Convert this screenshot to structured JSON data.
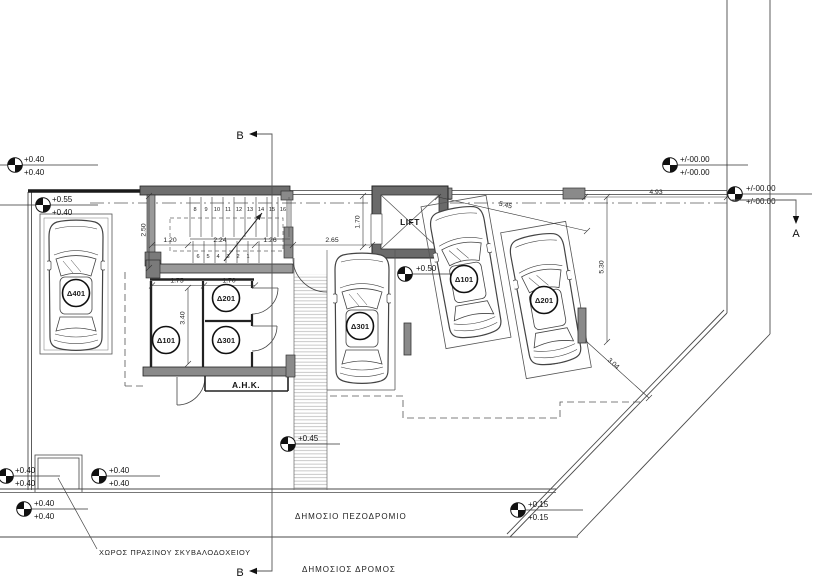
{
  "labels": {
    "lift": "LIFT",
    "ahk": "A.H.K.",
    "sidewalk": "ΔΗΜΟΣΙΟ ΠΕΖΟΔΡΟΜΙΟ",
    "road": "ΔΗΜΟΣΙΟΣ ΔΡΟΜΟΣ",
    "bin": "ΧΩΡΟΣ ΠΡΑΣΙΝΟΥ ΣΚΥΒΑΛΟΔΟΧΕΙΟΥ"
  },
  "sections": {
    "a": "A",
    "b_top": "B",
    "b_bottom": "B"
  },
  "levels": [
    {
      "a": "+0.40",
      "b": "+0.40"
    },
    {
      "a": "+0.55",
      "b": "+0.40"
    },
    {
      "a": "+0.50"
    },
    {
      "a": "+/-00.00",
      "b": "+/-00.00"
    },
    {
      "a": "+/-00.00",
      "b": "+/-00.00"
    },
    {
      "a": "+0.45"
    },
    {
      "a": "+0.15",
      "b": "+0.15"
    },
    {
      "a": "+0.40",
      "b": "+0.40"
    },
    {
      "a": "+0.40",
      "b": "+0.40"
    },
    {
      "a": "+0.40",
      "b": "+0.40"
    }
  ],
  "dims": {
    "stair_hall_depth": "2.50",
    "flight_w": "1.20",
    "stair_len": "2.24",
    "landing": "1.26",
    "entry_w": "2.65",
    "lift_depth": "1.70",
    "store1_w": "1.75",
    "store23_w": "1.70",
    "store_depth": "3.40",
    "bay_len": "5.45",
    "side_len": "5.30",
    "front_len": "4.93",
    "corner": "3.04"
  },
  "stairs": {
    "upper": [
      "8",
      "9",
      "10",
      "11",
      "12",
      "13",
      "14",
      "15",
      "16"
    ],
    "lower": [
      "6",
      "5",
      "4",
      "3",
      "2",
      "1"
    ]
  },
  "badges": {
    "car_left": "Δ401",
    "car_mid": "Δ301",
    "car_r1": "Δ101",
    "car_r2": "Δ201",
    "store1": "Δ101",
    "store2": "Δ201",
    "store3": "Δ301"
  },
  "colors": {
    "line": "#3a3a3a",
    "wall_fill": "#7a7a7a",
    "hatch": "#b0b0b0"
  }
}
